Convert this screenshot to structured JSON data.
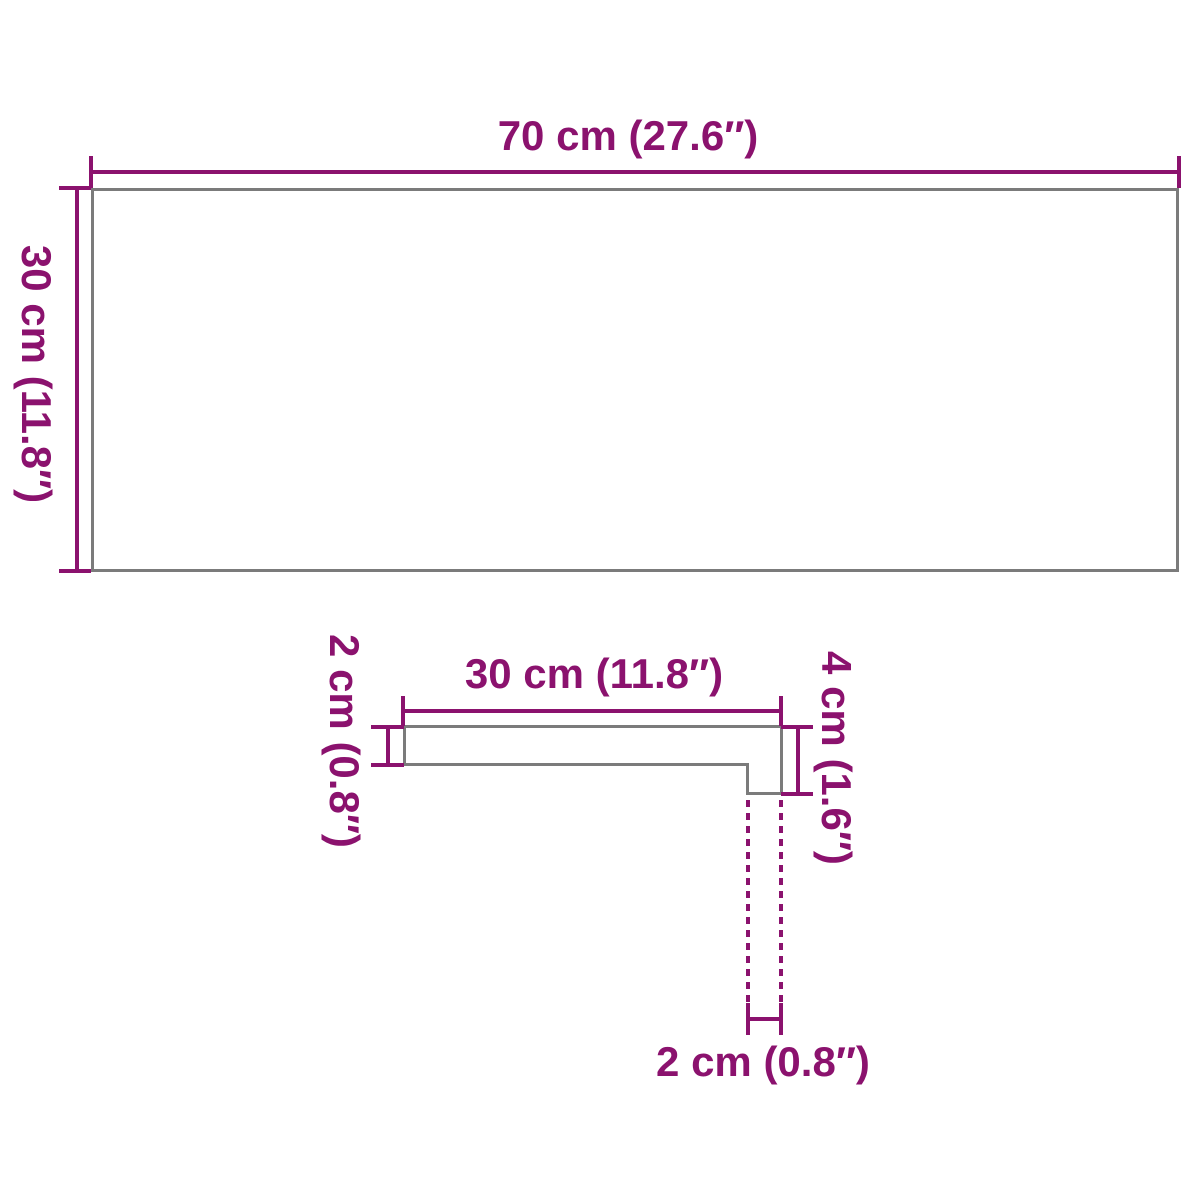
{
  "diagram": {
    "colors": {
      "accent": "#8B126E",
      "outline": "#7B7B7B",
      "bg": "#FFFFFF"
    },
    "top_view": {
      "width_label": "70 cm (27.6″)",
      "height_label": "30 cm (11.8″)"
    },
    "profile_view": {
      "width_label": "30 cm (11.8″)",
      "thickness_label": "2 cm (0.8″)",
      "nose_height_label": "4 cm (1.6″)",
      "nose_thickness_label": "2 cm (0.8″)"
    }
  }
}
